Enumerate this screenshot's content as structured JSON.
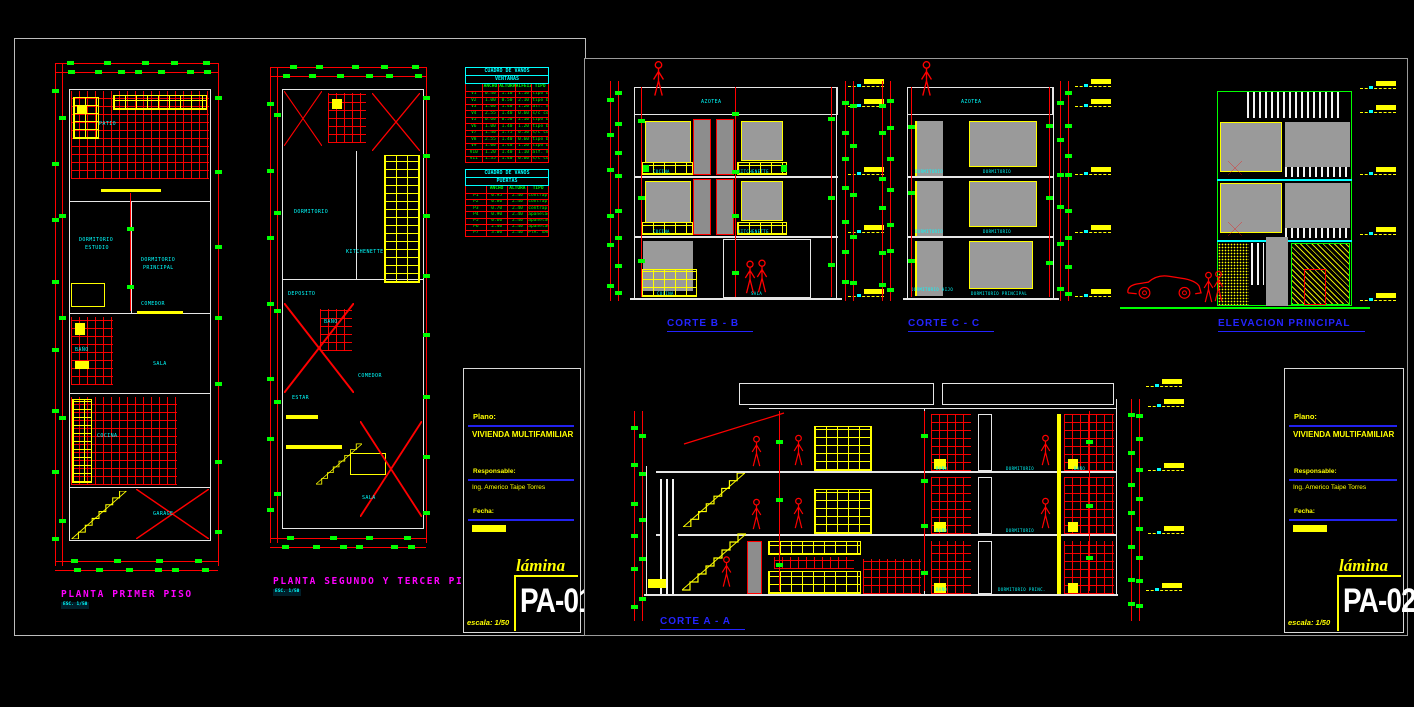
{
  "colors": {
    "red": "#ff0000",
    "yellow": "#ffff00",
    "green": "#00ff00",
    "cyan": "#00ffff",
    "magenta": "#ff00ff",
    "blue": "#2424ff",
    "panel_gray": "#9a9a9a",
    "background": "#000000"
  },
  "sheets": {
    "pa01": {
      "plans": [
        {
          "title": "PLANTA PRIMER PISO",
          "scale": "ESC. 1/50",
          "rooms": [
            "PATIO",
            "DORMITORIO",
            "ESTUDIO",
            "DORMITORIO",
            "PRINCIPAL",
            "BAÑO",
            "COMEDOR",
            "SALA",
            "COCINA",
            "GARAGE"
          ]
        },
        {
          "title": "PLANTA SEGUNDO Y TERCER PISO",
          "scale": "ESC. 1/50",
          "rooms": [
            "DORMITORIO",
            "DEPOSITO",
            "KITCHENETTE",
            "ESTAR",
            "COMEDOR",
            "BAÑO",
            "SALA",
            "TERRAZA"
          ]
        }
      ],
      "tables": {
        "ventanas": {
          "title1": "CUADRO DE VANOS",
          "title2": "VENTANAS",
          "headers": [
            "",
            "ANCHO",
            "ALTURA",
            "ALFEIZAR",
            "TIPO"
          ],
          "rows": [
            [
              "V1",
              "0.40",
              "1.10",
              "1.10",
              "tipo bandera"
            ],
            [
              "V2",
              "1.00",
              "0.50",
              "2.10",
              "tipo bandera"
            ],
            [
              "V3",
              "1.00",
              "1.40",
              "1.20",
              "alf. madera"
            ],
            [
              "V4",
              "2.55",
              "1.40",
              "0.60",
              "s/c corrediza"
            ],
            [
              "V5",
              "0.60",
              "0.50",
              "2.10",
              "tipo bandera"
            ],
            [
              "V6",
              "1.00",
              "1.40",
              "1.20",
              "tipo bandera"
            ],
            [
              "V7",
              "1.40",
              "1.75",
              "0.50",
              "s/c corrediza"
            ],
            [
              "V8",
              "2.55",
              "1.40",
              "0.60",
              "tipo bandera"
            ],
            [
              "V9",
              "1.00",
              "1.40",
              "1.20",
              "tipo bandera"
            ],
            [
              "V10",
              "1.20",
              "1.40",
              "1.10",
              "alf. madera"
            ],
            [
              "V11",
              "1.35",
              "1.40",
              "0.60",
              "s/c corrediza"
            ]
          ]
        },
        "puertas": {
          "title1": "CUADRO DE VANOS",
          "title2": "PUERTAS",
          "headers": [
            "",
            "ANCHO",
            "ALTURA",
            "TIPO"
          ],
          "rows": [
            [
              "P1",
              "0.95",
              "2.40",
              "contraplacada"
            ],
            [
              "P2",
              "0.80",
              "2.40",
              "contraplacada"
            ],
            [
              "P3",
              "0.70",
              "2.40",
              "contraplacada"
            ],
            [
              "P4",
              "0.90",
              "2.40",
              "apanelada"
            ],
            [
              "P5",
              "0.60",
              "2.40",
              "apanelada"
            ],
            [
              "P6",
              "2.40",
              "2.40",
              "apanelada  corrediza"
            ],
            [
              "P7",
              "3.00",
              "2.40",
              "PTA. GARAGE"
            ]
          ]
        }
      },
      "titleblock": {
        "plano_label": "Plano:",
        "plano": "VIVIENDA MULTIFAMILIAR",
        "resp_label": "Responsable:",
        "resp": "Ing. Americo Taipe Torres",
        "fecha_label": "Fecha:",
        "lamina_label": "lámina",
        "lamina": "PA-01",
        "escala": "escala: 1/50"
      }
    },
    "pa02": {
      "sections": [
        {
          "title": "CORTE  B - B",
          "rooms": [
            "AZOTEA",
            "COCINA",
            "KITCHENETTE",
            "COCINA",
            "KITCHENETTE",
            "COCINA",
            "SALA"
          ]
        },
        {
          "title": "CORTE  C - C",
          "rooms": [
            "AZOTEA",
            "DORMITORIO",
            "DORMITORIO",
            "DORMITORIO",
            "DORMITORIO",
            "DORMITORIO HIJO",
            "DORMITORIO PRINCIPAL"
          ]
        },
        {
          "title": "ELEVACION PRINCIPAL"
        },
        {
          "title": "CORTE  A - A",
          "rooms": [
            "BAÑO",
            "DORMITORIO",
            "BAÑO",
            "BAÑO",
            "DORMITORIO",
            "BAÑO",
            "DORMITORIO PRINC."
          ]
        }
      ],
      "titleblock": {
        "plano_label": "Plano:",
        "plano": "VIVIENDA MULTIFAMILIAR",
        "resp_label": "Responsable:",
        "resp": "Ing. Americo Taipe Torres",
        "fecha_label": "Fecha:",
        "lamina_label": "lámina",
        "lamina": "PA-02",
        "escala": "escala: 1/50"
      }
    }
  }
}
